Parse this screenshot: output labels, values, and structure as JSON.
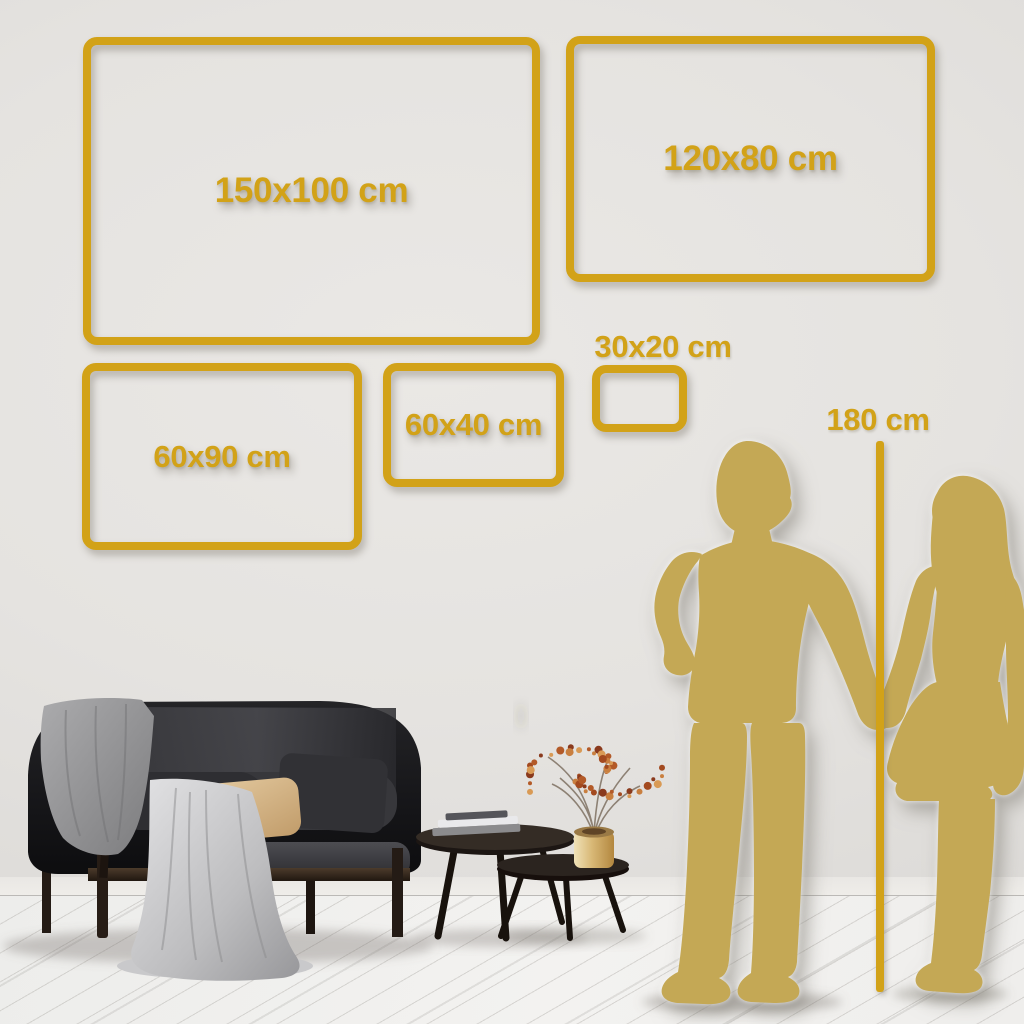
{
  "size_chart": {
    "frames": [
      {
        "id": "150x100",
        "label": "150x100 cm"
      },
      {
        "id": "120x80",
        "label": "120x80 cm"
      },
      {
        "id": "60x90",
        "label": "60x90 cm"
      },
      {
        "id": "60x40",
        "label": "60x40 cm"
      },
      {
        "id": "30x20",
        "label": "30x20 cm"
      }
    ],
    "height_marker": {
      "label": "180 cm"
    },
    "colors": {
      "accent_gold": "#d2a218",
      "silhouette_gold": "#c4a855",
      "wall": "#e5e3e0",
      "floor": "#f2f1ef"
    }
  },
  "scene_elements": {
    "left": [
      "sofa",
      "blanket",
      "tan-pillow",
      "dark-pillow",
      "coffee-tables",
      "books",
      "gold-vase",
      "berry-branch"
    ],
    "right": [
      "man-silhouette",
      "woman-silhouette",
      "height-line"
    ]
  }
}
